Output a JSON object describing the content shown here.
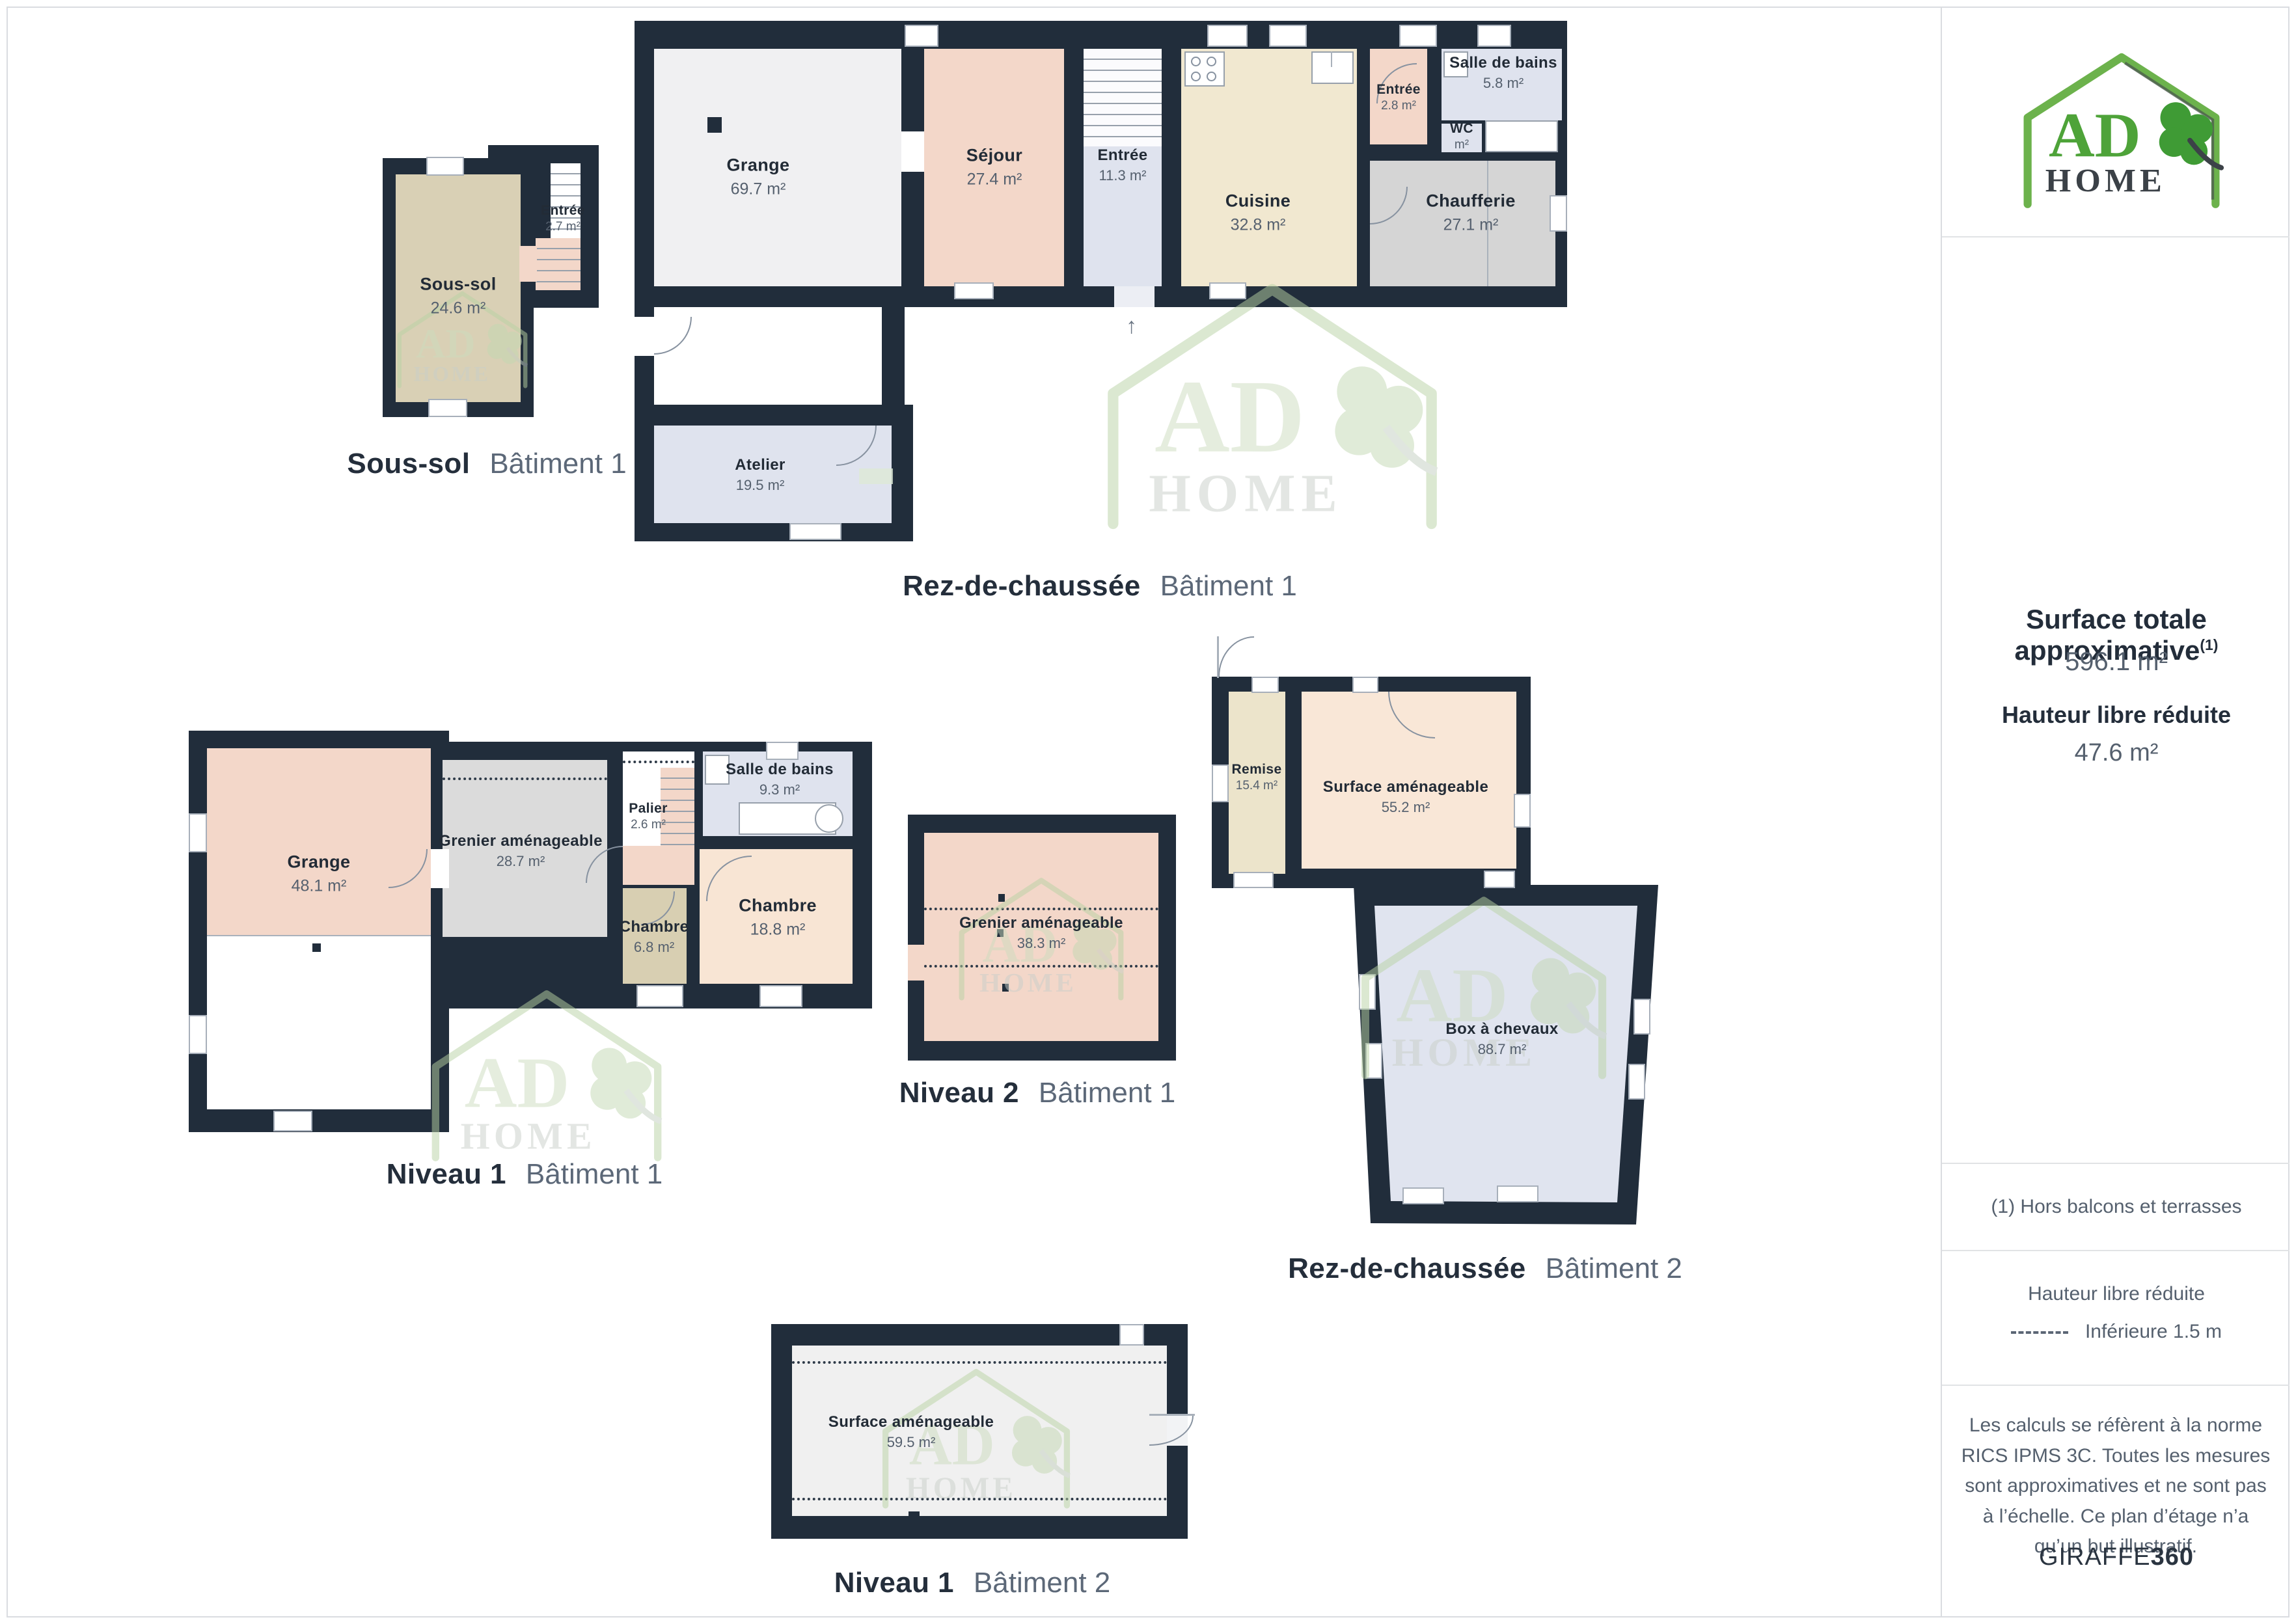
{
  "brand": {
    "logo_line1": "AD",
    "logo_line2": "HOME"
  },
  "sidebar": {
    "surface_total_label": "Surface totale approximative",
    "surface_total_sup": "(1)",
    "surface_total_value": "596.1 m²",
    "reduced_height_label": "Hauteur libre réduite",
    "reduced_height_value": "47.6 m²",
    "footnote": "(1) Hors balcons et terrasses",
    "legend_title": "Hauteur libre réduite",
    "legend_item": "Inférieure 1.5 m",
    "disclaimer": "Les calculs se réfèrent à la norme RICS IPMS 3C. Toutes les mesures sont approximatives et ne sont pas à l’échelle. Ce plan d’étage n’a qu’un but illustratif.",
    "credit_brand": "GIRAFFE",
    "credit_brand_bold": "360"
  },
  "plans": {
    "sous_sol_b1": {
      "title": "Sous-sol",
      "building": "Bâtiment 1",
      "rooms": {
        "sous_sol": {
          "name": "Sous-sol",
          "area": "24.6 m²"
        },
        "entree": {
          "name": "Entrée",
          "area": "2.7 m²"
        }
      }
    },
    "rdc_b1": {
      "title": "Rez-de-chaussée",
      "building": "Bâtiment 1",
      "rooms": {
        "grange": {
          "name": "Grange",
          "area": "69.7 m²"
        },
        "sejour": {
          "name": "Séjour",
          "area": "27.4 m²"
        },
        "entree": {
          "name": "Entrée",
          "area": "11.3 m²"
        },
        "cuisine": {
          "name": "Cuisine",
          "area": "32.8 m²"
        },
        "entree_2": {
          "name": "Entrée",
          "area": "2.8 m²"
        },
        "salle_de_bains": {
          "name": "Salle de bains",
          "area": "5.8 m²"
        },
        "wc": {
          "name": "WC",
          "area": "m²"
        },
        "chaufferie": {
          "name": "Chaufferie",
          "area": "27.1 m²"
        },
        "atelier": {
          "name": "Atelier",
          "area": "19.5 m²"
        }
      }
    },
    "niveau1_b1": {
      "title": "Niveau 1",
      "building": "Bâtiment 1",
      "rooms": {
        "grange": {
          "name": "Grange",
          "area": "48.1 m²"
        },
        "grenier": {
          "name": "Grenier aménageable",
          "area": "28.7 m²"
        },
        "palier": {
          "name": "Palier",
          "area": "2.6 m²"
        },
        "salle_de_bains": {
          "name": "Salle de bains",
          "area": "9.3 m²"
        },
        "chambre_1": {
          "name": "Chambre",
          "area": "6.8 m²"
        },
        "chambre_2": {
          "name": "Chambre",
          "area": "18.8 m²"
        }
      }
    },
    "niveau2_b1": {
      "title": "Niveau 2",
      "building": "Bâtiment 1",
      "rooms": {
        "grenier": {
          "name": "Grenier aménageable",
          "area": "38.3 m²"
        }
      }
    },
    "rdc_b2": {
      "title": "Rez-de-chaussée",
      "building": "Bâtiment 2",
      "rooms": {
        "remise": {
          "name": "Remise",
          "area": "15.4 m²"
        },
        "surface": {
          "name": "Surface aménageable",
          "area": "55.2 m²"
        },
        "box": {
          "name": "Box à chevaux",
          "area": "88.7 m²"
        }
      }
    },
    "niveau1_b2": {
      "title": "Niveau 1",
      "building": "Bâtiment 2",
      "rooms": {
        "surface": {
          "name": "Surface aménageable",
          "area": "59.5 m²"
        }
      }
    }
  }
}
